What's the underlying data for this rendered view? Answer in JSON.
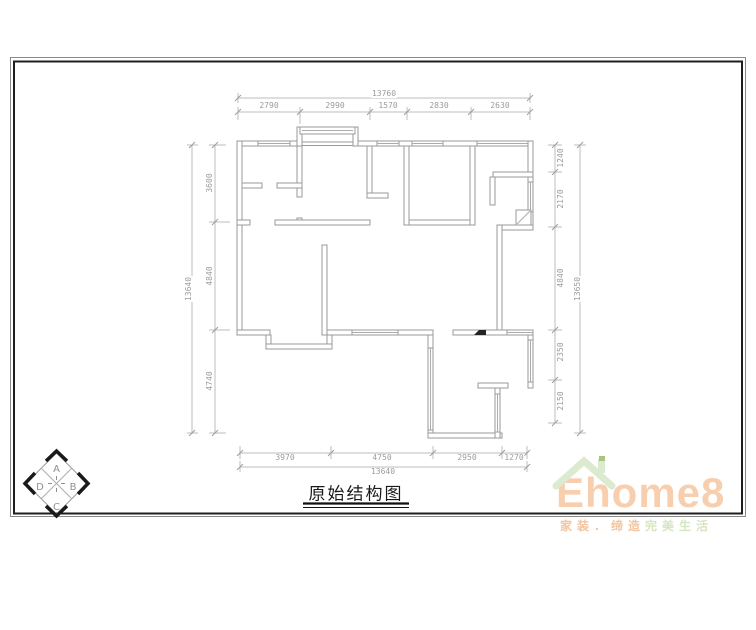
{
  "sheet": {
    "title": "原始结构图"
  },
  "dimensions": {
    "top": {
      "total": "13760",
      "segments": [
        "2790",
        "2990",
        "1570",
        "2830",
        "2630"
      ]
    },
    "bottom": {
      "total": "13640",
      "segments": [
        "3970",
        "4750",
        "2950",
        "1270"
      ]
    },
    "left": {
      "total": "13640",
      "segments": [
        "3600",
        "4840",
        "4740"
      ]
    },
    "right": {
      "total": "13650",
      "segments": [
        "1240",
        "2170",
        "4840",
        "2350",
        "2150"
      ]
    }
  },
  "compass": {
    "labels": [
      "A",
      "B",
      "C",
      "D"
    ]
  },
  "logo": {
    "brand": "Ehome8",
    "tagline_primary": "家装．缔造",
    "tagline_secondary": "完美生活",
    "colors": {
      "brand_text": "#f8cfae",
      "roof": "#dcead0",
      "chimney_accent": "#aac47f",
      "tagline_primary": "#f2c5a0",
      "tagline_secondary": "#d6e5c1",
      "wall_line": "#9a9a9a",
      "dimension_line": "#bcbcbc"
    }
  }
}
